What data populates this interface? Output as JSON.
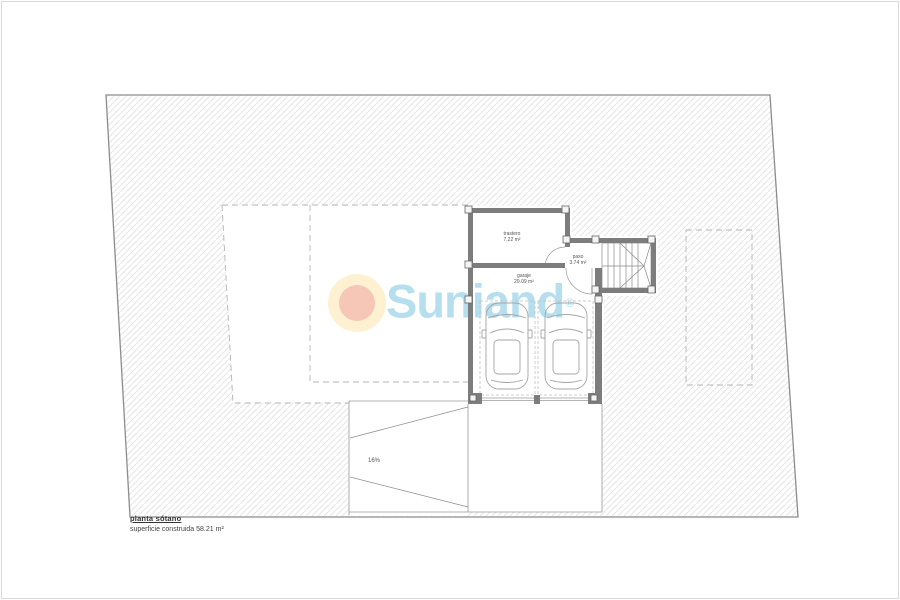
{
  "plan": {
    "title": "planta sótano",
    "subtitle": "superficie construida 58.21 m²",
    "rooms": [
      {
        "name": "trastero",
        "area": "7.22 m²"
      },
      {
        "name": "paso",
        "area": "3.74 m²"
      },
      {
        "name": "garaje",
        "area": "29.09 m²"
      }
    ],
    "ramp_slope": "16%"
  },
  "watermark": {
    "brand": "Suniand",
    "registered": "®",
    "text_color": "#a6d8ec",
    "sun_outer_color": "#fdeec9",
    "sun_inner_color": "#f5bba8"
  },
  "drawing_colors": {
    "wall": "#7d7d7d",
    "boundary": "#8c8c8c",
    "hatch": "#e4e4e4",
    "dashed": "#b5b5b5",
    "thin_line": "#9a9a9a"
  }
}
